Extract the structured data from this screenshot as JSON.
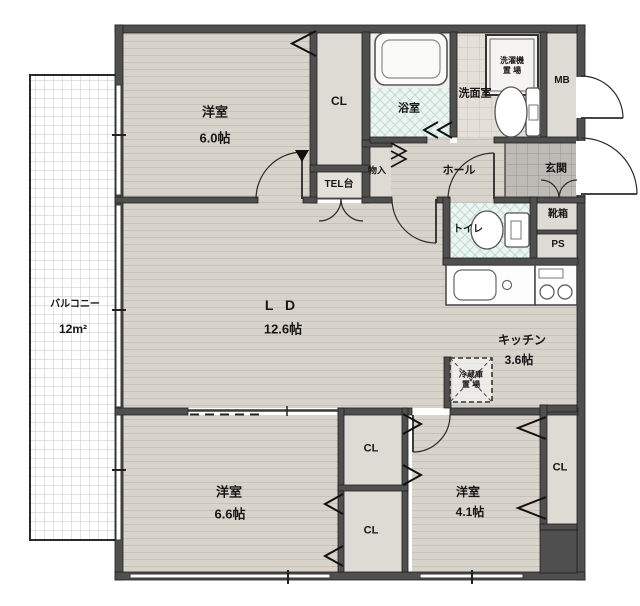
{
  "rooms": {
    "bedroom1": {
      "name": "洋室",
      "size": "6.0帖"
    },
    "bedroom2": {
      "name": "洋室",
      "size": "6.6帖"
    },
    "bedroom3": {
      "name": "洋室",
      "size": "4.1帖"
    },
    "living_dining": {
      "name": "L D",
      "size": "12.6帖"
    },
    "kitchen": {
      "name": "キッチン",
      "size": "3.6帖"
    },
    "balcony": {
      "name": "バルコニー",
      "size": "12m²"
    },
    "hall": {
      "name": "ホール"
    },
    "entrance": {
      "name": "玄関"
    },
    "bath": {
      "name": "浴室"
    },
    "washroom": {
      "name": "洗面室"
    },
    "toilet": {
      "name": "トイレ"
    },
    "laundry_space": {
      "line1": "洗濯機",
      "line2": "置 場"
    },
    "fridge_space": {
      "line1": "冷蔵庫",
      "line2": "置 場"
    },
    "tel_stand": {
      "name": "TEL台"
    },
    "storage": {
      "name": "物入"
    },
    "shoe_box": {
      "name": "靴箱"
    },
    "meter_box": {
      "name": "MB"
    },
    "pipe_space": {
      "name": "PS"
    },
    "closet_top": {
      "name": "CL"
    },
    "closet_mid_upper": {
      "name": "CL"
    },
    "closet_mid_lower": {
      "name": "CL"
    },
    "closet_right": {
      "name": "CL"
    }
  },
  "colors": {
    "wall": "#4f4f4f",
    "floor_wood": "#d8d4cc",
    "floor_line": "#c7c3bb",
    "closet_plain": "#dedbd5",
    "bath_tile": "#edf5f1",
    "wash_tile": "#e4e0d8",
    "entry_tile": "#bebbb7",
    "balcony_white": "#ffffff"
  }
}
